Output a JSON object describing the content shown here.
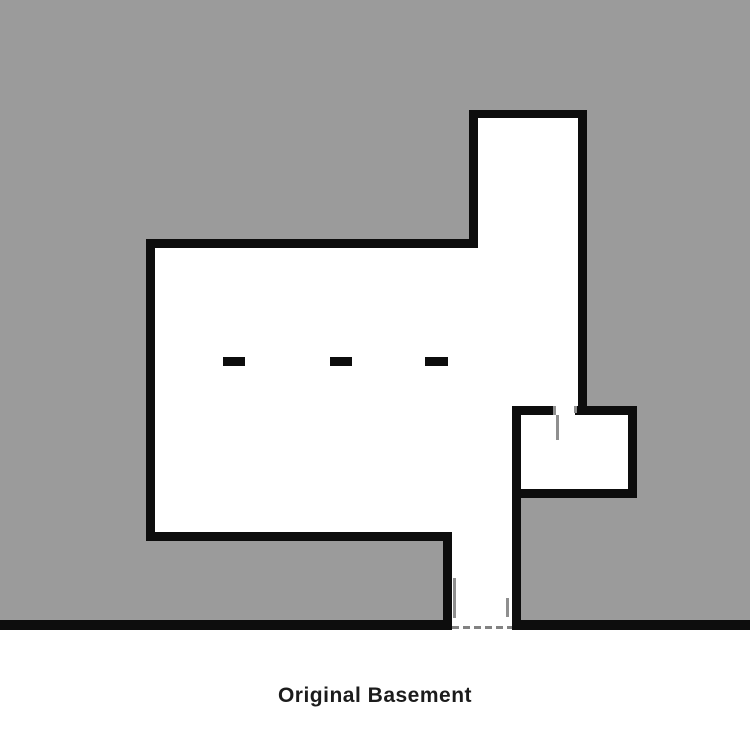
{
  "figure": {
    "caption": "Original Basement",
    "type": "architectural-floor-plan",
    "column_marker_count": 3
  },
  "colors": {
    "site-gray": "#9b9b9b",
    "wall-black": "#0d0d0d",
    "detail-gray": "#8f8f8f",
    "dash-gray": "#828282",
    "paper-white": "#ffffff",
    "caption-color": "#1c1c1c"
  }
}
